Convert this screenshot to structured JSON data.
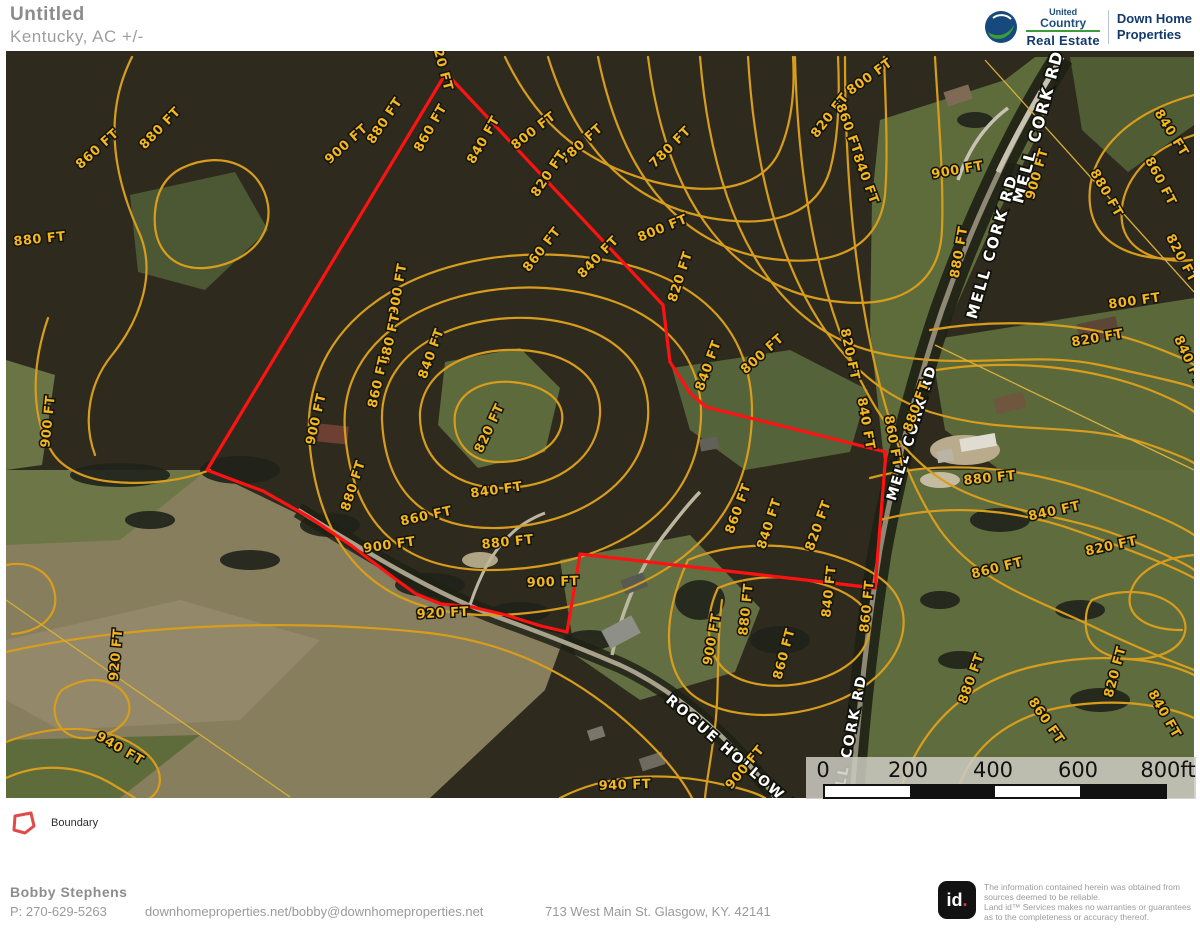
{
  "header": {
    "title": "Untitled",
    "subtitle": "Kentucky,  AC +/-"
  },
  "branding": {
    "uc_line1": "United",
    "uc_line2": "Country",
    "uc_line3": "Real Estate",
    "partner_line1": "Down Home",
    "partner_line2": "Properties"
  },
  "legend": {
    "boundary_label": "Boundary"
  },
  "scalebar": {
    "labels": [
      "0",
      "200",
      "400",
      "600",
      "800ft"
    ]
  },
  "map": {
    "boundary_color": "#ff1212",
    "contour_color": "#d89d1d",
    "boundary_points": "446,73 663,305 670,362 690,393 706,407 886,452 875,588 580,554 567,632 541,626 506,615 472,607 441,604 416,594 394,578 352,546 309,517 263,491 228,478 207,470",
    "road_labels": [
      {
        "t": "MELL CORK RD",
        "x": 1043,
        "y": 128,
        "r": -75,
        "s": 16
      },
      {
        "t": "MELL CORK RD",
        "x": 997,
        "y": 248,
        "r": -74,
        "s": 15
      },
      {
        "t": "MELL CORK RD",
        "x": 916,
        "y": 434,
        "r": -73,
        "s": 14
      },
      {
        "t": "MELL CORK RD",
        "x": 853,
        "y": 745,
        "r": -79,
        "s": 14
      },
      {
        "t": "ROGUE HOLLOW RD",
        "x": 735,
        "y": 762,
        "r": 41,
        "s": 14
      }
    ],
    "contour_labels": [
      {
        "t": "820 FT",
        "x": 438,
        "y": 66,
        "r": 75
      },
      {
        "t": "880 FT",
        "x": 388,
        "y": 123,
        "r": -56
      },
      {
        "t": "860 FT",
        "x": 434,
        "y": 130,
        "r": -60
      },
      {
        "t": "840 FT",
        "x": 487,
        "y": 142,
        "r": -60
      },
      {
        "t": "800 FT",
        "x": 536,
        "y": 134,
        "r": -38
      },
      {
        "t": "780 FT",
        "x": 584,
        "y": 147,
        "r": -42
      },
      {
        "t": "780 FT",
        "x": 673,
        "y": 150,
        "r": -45
      },
      {
        "t": "820 FT",
        "x": 552,
        "y": 176,
        "r": -56
      },
      {
        "t": "800 FT",
        "x": 664,
        "y": 232,
        "r": -22
      },
      {
        "t": "860 FT",
        "x": 545,
        "y": 252,
        "r": -52
      },
      {
        "t": "840 FT",
        "x": 601,
        "y": 260,
        "r": -46
      },
      {
        "t": "820 FT",
        "x": 684,
        "y": 278,
        "r": -72
      },
      {
        "t": "900 FT",
        "x": 349,
        "y": 147,
        "r": -42
      },
      {
        "t": "860 FT",
        "x": 100,
        "y": 152,
        "r": -42
      },
      {
        "t": "880 FT",
        "x": 163,
        "y": 131,
        "r": -46
      },
      {
        "t": "880 FT",
        "x": 40,
        "y": 243,
        "r": -6
      },
      {
        "t": "900 FT",
        "x": 52,
        "y": 422,
        "r": -84
      },
      {
        "t": "900 FT",
        "x": 402,
        "y": 290,
        "r": -80
      },
      {
        "t": "880 FT",
        "x": 394,
        "y": 340,
        "r": -77
      },
      {
        "t": "860 FT",
        "x": 382,
        "y": 383,
        "r": -77
      },
      {
        "t": "840 FT",
        "x": 435,
        "y": 355,
        "r": -70
      },
      {
        "t": "820 FT",
        "x": 493,
        "y": 430,
        "r": -65
      },
      {
        "t": "900 FT",
        "x": 320,
        "y": 420,
        "r": -77
      },
      {
        "t": "880 FT",
        "x": 357,
        "y": 487,
        "r": -72
      },
      {
        "t": "860 FT",
        "x": 427,
        "y": 520,
        "r": -12
      },
      {
        "t": "840 FT",
        "x": 497,
        "y": 494,
        "r": -8
      },
      {
        "t": "880 FT",
        "x": 508,
        "y": 546,
        "r": -6
      },
      {
        "t": "900 FT",
        "x": 390,
        "y": 549,
        "r": -8
      },
      {
        "t": "900 FT",
        "x": 553,
        "y": 586,
        "r": -2
      },
      {
        "t": "920 FT",
        "x": 443,
        "y": 617,
        "r": -3
      },
      {
        "t": "920 FT",
        "x": 120,
        "y": 655,
        "r": -85
      },
      {
        "t": "940 FT",
        "x": 118,
        "y": 752,
        "r": 30
      },
      {
        "t": "940 FT",
        "x": 625,
        "y": 789,
        "r": -2
      },
      {
        "t": "800 FT",
        "x": 872,
        "y": 80,
        "r": -36
      },
      {
        "t": "820 FT",
        "x": 833,
        "y": 118,
        "r": -52
      },
      {
        "t": "860 FT",
        "x": 845,
        "y": 130,
        "r": 70
      },
      {
        "t": "840 FT",
        "x": 862,
        "y": 180,
        "r": 70
      },
      {
        "t": "840 FT",
        "x": 712,
        "y": 367,
        "r": -70
      },
      {
        "t": "800 FT",
        "x": 765,
        "y": 357,
        "r": -42
      },
      {
        "t": "820 FT",
        "x": 846,
        "y": 355,
        "r": 78
      },
      {
        "t": "840 FT",
        "x": 862,
        "y": 424,
        "r": 80
      },
      {
        "t": "860 FT",
        "x": 889,
        "y": 442,
        "r": 80
      },
      {
        "t": "880 FT",
        "x": 920,
        "y": 408,
        "r": -70
      },
      {
        "t": "880 FT",
        "x": 990,
        "y": 482,
        "r": -6
      },
      {
        "t": "860 FT",
        "x": 742,
        "y": 510,
        "r": -70
      },
      {
        "t": "840 FT",
        "x": 773,
        "y": 525,
        "r": -72
      },
      {
        "t": "820 FT",
        "x": 822,
        "y": 527,
        "r": -70
      },
      {
        "t": "880 FT",
        "x": 750,
        "y": 610,
        "r": -84
      },
      {
        "t": "860 FT",
        "x": 871,
        "y": 607,
        "r": -84
      },
      {
        "t": "840 FT",
        "x": 833,
        "y": 592,
        "r": -84
      },
      {
        "t": "900 FT",
        "x": 716,
        "y": 640,
        "r": -80
      },
      {
        "t": "900 FT",
        "x": 748,
        "y": 770,
        "r": -50
      },
      {
        "t": "860 FT",
        "x": 788,
        "y": 655,
        "r": -75
      },
      {
        "t": "900 FT",
        "x": 1041,
        "y": 175,
        "r": -74
      },
      {
        "t": "900 FT",
        "x": 958,
        "y": 174,
        "r": -10
      },
      {
        "t": "880 FT",
        "x": 1103,
        "y": 195,
        "r": 60
      },
      {
        "t": "860 FT",
        "x": 1157,
        "y": 183,
        "r": 62
      },
      {
        "t": "840 FT",
        "x": 1168,
        "y": 135,
        "r": 58
      },
      {
        "t": "820 FT",
        "x": 1178,
        "y": 260,
        "r": 62
      },
      {
        "t": "880 FT",
        "x": 963,
        "y": 253,
        "r": -80
      },
      {
        "t": "800 FT",
        "x": 1135,
        "y": 305,
        "r": -8
      },
      {
        "t": "820 FT",
        "x": 1098,
        "y": 342,
        "r": -10
      },
      {
        "t": "840 FT",
        "x": 1185,
        "y": 362,
        "r": 65
      },
      {
        "t": "840 FT",
        "x": 1055,
        "y": 515,
        "r": -12
      },
      {
        "t": "820 FT",
        "x": 1112,
        "y": 550,
        "r": -12
      },
      {
        "t": "860 FT",
        "x": 998,
        "y": 572,
        "r": -14
      },
      {
        "t": "880 FT",
        "x": 975,
        "y": 680,
        "r": -70
      },
      {
        "t": "860 FT",
        "x": 1043,
        "y": 723,
        "r": 55
      },
      {
        "t": "820 FT",
        "x": 1119,
        "y": 673,
        "r": -75
      },
      {
        "t": "840 FT",
        "x": 1161,
        "y": 716,
        "r": 60
      }
    ]
  },
  "footer": {
    "agent_name": "Bobby  Stephens",
    "phone": "P: 270-629-5263",
    "website": "downhomeproperties.net/bobby@downhomeproperties.net",
    "address": "713 West Main St. Glasgow, KY. 42141"
  },
  "disclaimer": {
    "logo_text": "id",
    "lines": [
      "The information contained herein was obtained from",
      "sources deemed to be reliable.",
      "Land id™ Services makes no warranties or guarantees",
      "as to the completeness or accuracy thereof."
    ]
  }
}
